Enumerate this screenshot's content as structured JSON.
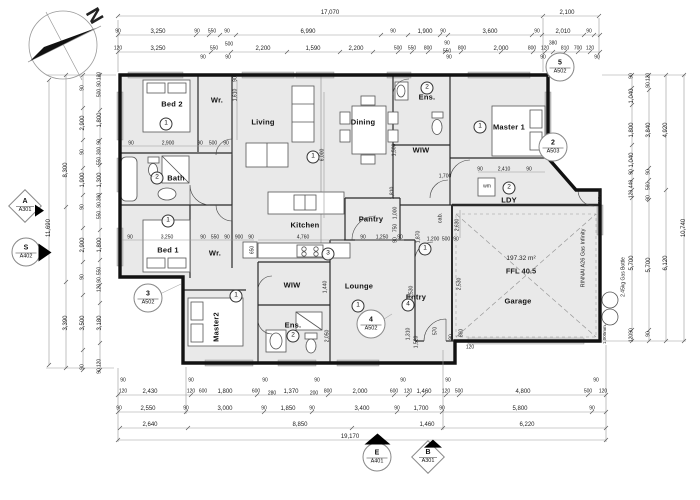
{
  "compass": {
    "north_label": "N"
  },
  "rooms": [
    [
      "Bed 2",
      172,
      104,
      0
    ],
    [
      "Wr.",
      217,
      100,
      0
    ],
    [
      "Living",
      263,
      122,
      0
    ],
    [
      "Dining",
      363,
      122,
      0
    ],
    [
      "Ens.",
      427,
      97,
      0
    ],
    [
      "Master 1",
      509,
      127,
      0
    ],
    [
      "WIW",
      421,
      150,
      0
    ],
    [
      "LDY",
      509,
      200,
      0
    ],
    [
      "Bath",
      176,
      178,
      0
    ],
    [
      "Bed 1",
      168,
      250,
      0
    ],
    [
      "Wr.",
      215,
      253,
      0
    ],
    [
      "Kitchen",
      305,
      225,
      0
    ],
    [
      "Pantry",
      371,
      219,
      0
    ],
    [
      "WIW",
      292,
      285,
      0
    ],
    [
      "Master2",
      216,
      327,
      -90
    ],
    [
      "Ens.",
      293,
      325,
      0
    ],
    [
      "Lounge",
      359,
      286,
      0
    ],
    [
      "Entry",
      416,
      297,
      0
    ],
    [
      "Garage",
      518,
      301,
      0
    ]
  ],
  "room_numbers": [
    {
      "n": "1",
      "x": 166,
      "y": 124
    },
    {
      "n": "2",
      "x": 157,
      "y": 178
    },
    {
      "n": "1",
      "x": 168,
      "y": 221
    },
    {
      "n": "1",
      "x": 313,
      "y": 157
    },
    {
      "n": "2",
      "x": 427,
      "y": 88
    },
    {
      "n": "1",
      "x": 480,
      "y": 127
    },
    {
      "n": "2",
      "x": 509,
      "y": 188
    },
    {
      "n": "3",
      "x": 328,
      "y": 254
    },
    {
      "n": "1",
      "x": 425,
      "y": 249
    },
    {
      "n": "1",
      "x": 236,
      "y": 296
    },
    {
      "n": "2",
      "x": 293,
      "y": 336
    },
    {
      "n": "1",
      "x": 358,
      "y": 306
    },
    {
      "n": "4",
      "x": 408,
      "y": 305
    }
  ],
  "markers": [
    {
      "n": "5",
      "code": "A502",
      "x": 560,
      "y": 67,
      "shape": "circle"
    },
    {
      "n": "2",
      "code": "A503",
      "x": 553,
      "y": 147,
      "shape": "circle"
    },
    {
      "n": "3",
      "code": "A502",
      "x": 148,
      "y": 298,
      "shape": "circle"
    },
    {
      "n": "4",
      "code": "A502",
      "x": 371,
      "y": 324,
      "shape": "circle"
    },
    {
      "n": "A",
      "code": "A301",
      "x": 25,
      "y": 206,
      "shape": "diamond ar-right"
    },
    {
      "n": "S",
      "code": "A402",
      "x": 26,
      "y": 252,
      "shape": "circle ar-right"
    },
    {
      "n": "E",
      "code": "A401",
      "x": 377,
      "y": 457,
      "shape": "circle ar-up"
    },
    {
      "n": "B",
      "code": "A301",
      "x": 428,
      "y": 457,
      "shape": "diamond ar-up"
    }
  ],
  "annotations": [
    {
      "t": "197.32 m²",
      "x": 521,
      "y": 259,
      "s": 6.5,
      "n": "area-label"
    },
    {
      "t": "FFL 40.5",
      "x": 521,
      "y": 271,
      "s": 7.5,
      "b": 1,
      "n": "ffl-label"
    },
    {
      "t": "RINNAI A26 Gas Infinity",
      "x": 584,
      "y": 258,
      "r": -90,
      "s": 5.5,
      "n": "gas-heater-label"
    },
    {
      "t": "2.45kg Gas Bottle",
      "x": 624,
      "y": 277,
      "r": -90,
      "s": 5,
      "n": "gas-bottle-label"
    },
    {
      "t": "1,000mm.",
      "x": 605,
      "y": 334,
      "r": -90,
      "s": 4.5,
      "n": "offset-label"
    },
    {
      "t": "300mm.",
      "x": 600,
      "y": 196,
      "r": -90,
      "s": 4.5,
      "n": "offset-label"
    },
    {
      "t": "wm",
      "x": 487,
      "y": 187,
      "s": 5,
      "n": "washing-machine-label"
    },
    {
      "t": "cab.",
      "x": 441,
      "y": 218,
      "r": -90,
      "s": 5.5,
      "n": "cabinet-label"
    },
    {
      "t": "N",
      "x": 94,
      "y": 16,
      "r": 60,
      "s": 20,
      "b": 1,
      "n": "north-label"
    }
  ],
  "dims": [
    [
      "17,070",
      330,
      13
    ],
    [
      "2,100",
      567,
      13
    ],
    [
      "90",
      118,
      32,
      0,
      5
    ],
    [
      "3,250",
      158,
      32
    ],
    [
      "90",
      197,
      32,
      0,
      5
    ],
    [
      "550",
      212,
      32,
      0,
      5
    ],
    [
      "90",
      227,
      32,
      0,
      5
    ],
    [
      "6,990",
      308,
      32
    ],
    [
      "90",
      393,
      32,
      0,
      5
    ],
    [
      "1,900",
      425,
      32
    ],
    [
      "90",
      443,
      32,
      0,
      5
    ],
    [
      "3,600",
      490,
      32
    ],
    [
      "90",
      537,
      32,
      0,
      5
    ],
    [
      "2,010",
      563,
      32
    ],
    [
      "90",
      589,
      32,
      0,
      5
    ],
    [
      "120",
      118,
      49,
      0,
      5
    ],
    [
      "3,250",
      158,
      49
    ],
    [
      "550",
      214,
      49,
      0,
      5
    ],
    [
      "500",
      229,
      45,
      0,
      5
    ],
    [
      "2,200",
      263,
      49
    ],
    [
      "1,590",
      313,
      49
    ],
    [
      "2,200",
      356,
      49
    ],
    [
      "500",
      398,
      49,
      0,
      5
    ],
    [
      "550",
      412,
      49,
      0,
      5
    ],
    [
      "800",
      428,
      49,
      0,
      5
    ],
    [
      "90",
      447,
      44,
      0,
      5
    ],
    [
      "550",
      447,
      52,
      0,
      5
    ],
    [
      "800",
      462,
      49,
      0,
      5
    ],
    [
      "2,000",
      501,
      49
    ],
    [
      "800",
      532,
      49,
      0,
      5
    ],
    [
      "120",
      545,
      49,
      0,
      5
    ],
    [
      "380",
      553,
      44,
      0,
      5
    ],
    [
      "810",
      565,
      49,
      0,
      5
    ],
    [
      "700",
      578,
      49,
      0,
      5
    ],
    [
      "120",
      590,
      49,
      0,
      5
    ],
    [
      "90",
      203,
      58,
      0,
      5
    ],
    [
      "90",
      228,
      58,
      0,
      5
    ],
    [
      "90",
      449,
      58,
      0,
      5
    ],
    [
      "90",
      543,
      58,
      0,
      5
    ],
    [
      "90",
      597,
      58,
      0,
      5
    ],
    [
      "90",
      123,
      381,
      0,
      5
    ],
    [
      "90",
      191,
      381,
      0,
      5
    ],
    [
      "90",
      265,
      381,
      0,
      5
    ],
    [
      "90",
      317,
      381,
      0,
      5
    ],
    [
      "90",
      403,
      381,
      0,
      5
    ],
    [
      "90",
      448,
      381,
      0,
      5
    ],
    [
      "90",
      596,
      381,
      0,
      5
    ],
    [
      "120",
      123,
      392,
      0,
      5
    ],
    [
      "2,430",
      150,
      392
    ],
    [
      "120",
      191,
      392,
      0,
      5
    ],
    [
      "600",
      203,
      392,
      0,
      5
    ],
    [
      "1,800",
      225,
      392
    ],
    [
      "600",
      256,
      392,
      0,
      5
    ],
    [
      "280",
      272,
      394,
      0,
      5
    ],
    [
      "1,370",
      291,
      392
    ],
    [
      "200",
      314,
      394,
      0,
      5
    ],
    [
      "800",
      328,
      392,
      0,
      5
    ],
    [
      "2,000",
      360,
      392
    ],
    [
      "600",
      394,
      392,
      0,
      5
    ],
    [
      "120",
      408,
      392,
      0,
      5
    ],
    [
      "1,460",
      424,
      392
    ],
    [
      "120",
      446,
      392,
      0,
      5
    ],
    [
      "500",
      459,
      392,
      0,
      5
    ],
    [
      "4,800",
      523,
      392
    ],
    [
      "500",
      588,
      392,
      0,
      5
    ],
    [
      "120",
      603,
      392,
      0,
      5
    ],
    [
      "90",
      119,
      409,
      0,
      5
    ],
    [
      "2,550",
      148,
      409
    ],
    [
      "90",
      186,
      409,
      0,
      5
    ],
    [
      "3,000",
      225,
      409
    ],
    [
      "90",
      264,
      409,
      0,
      5
    ],
    [
      "1,850",
      288,
      409
    ],
    [
      "90",
      312,
      409,
      0,
      5
    ],
    [
      "3,400",
      362,
      409
    ],
    [
      "90",
      397,
      409,
      0,
      5
    ],
    [
      "1,700",
      421,
      409
    ],
    [
      "90",
      442,
      409,
      0,
      5
    ],
    [
      "5,800",
      520,
      409
    ],
    [
      "90",
      592,
      409,
      0,
      5
    ],
    [
      "2,640",
      150,
      425
    ],
    [
      "8,850",
      300,
      425
    ],
    [
      "1,460",
      427,
      425
    ],
    [
      "6,220",
      527,
      425
    ],
    [
      "19,170",
      350,
      437
    ],
    [
      "120",
      100,
      76,
      -90,
      5
    ],
    [
      "90",
      100,
      84,
      -90,
      5
    ],
    [
      "500",
      100,
      93,
      -90,
      5
    ],
    [
      "1,800",
      100,
      120,
      -90
    ],
    [
      "90",
      100,
      142,
      -90,
      5
    ],
    [
      "300",
      100,
      151,
      -90,
      5
    ],
    [
      "550",
      100,
      161,
      -90,
      5
    ],
    [
      "1,300",
      100,
      180,
      -90
    ],
    [
      "300",
      100,
      197,
      -90,
      5
    ],
    [
      "90",
      100,
      205,
      -90,
      5
    ],
    [
      "550",
      100,
      215,
      -90,
      5
    ],
    [
      "1,800",
      100,
      245,
      -90
    ],
    [
      "550",
      100,
      271,
      -90,
      5
    ],
    [
      "90",
      100,
      280,
      -90,
      5
    ],
    [
      "120",
      100,
      288,
      -90,
      5
    ],
    [
      "3,180",
      100,
      323,
      -90
    ],
    [
      "120",
      100,
      363,
      -90,
      5
    ],
    [
      "90",
      100,
      371,
      -90,
      5
    ],
    [
      "90",
      83,
      88,
      -90,
      5
    ],
    [
      "2,900",
      83,
      123,
      -90
    ],
    [
      "90",
      83,
      152,
      -90,
      5
    ],
    [
      "1,900",
      83,
      180,
      -90
    ],
    [
      "90",
      83,
      207,
      -90,
      5
    ],
    [
      "2,900",
      83,
      245,
      -90
    ],
    [
      "90",
      83,
      277,
      -90,
      5
    ],
    [
      "3,500",
      83,
      323,
      -90
    ],
    [
      "90",
      83,
      367,
      -90,
      5
    ],
    [
      "8,300",
      66,
      170,
      -90
    ],
    [
      "3,390",
      66,
      323,
      -90
    ],
    [
      "11,690",
      49,
      228,
      -90
    ],
    [
      "90",
      632,
      76,
      -90,
      5
    ],
    [
      "1,040",
      632,
      96,
      -90
    ],
    [
      "1,800",
      632,
      130,
      -90
    ],
    [
      "1,040",
      632,
      160,
      -90
    ],
    [
      "90",
      632,
      172,
      -90,
      5
    ],
    [
      "440",
      632,
      184,
      -90,
      5
    ],
    [
      "120",
      632,
      194,
      -90,
      5
    ],
    [
      "5,700",
      632,
      263,
      -90
    ],
    [
      "90",
      632,
      331,
      -90,
      5
    ],
    [
      "120",
      632,
      338,
      -90,
      5
    ],
    [
      "120",
      649,
      77,
      -90,
      5
    ],
    [
      "90",
      649,
      85,
      -90,
      5
    ],
    [
      "3,840",
      649,
      130,
      -90
    ],
    [
      "90",
      649,
      172,
      -90,
      5
    ],
    [
      "560",
      649,
      186,
      -90,
      5
    ],
    [
      "90",
      649,
      198,
      -90,
      5
    ],
    [
      "5,700",
      649,
      265,
      -90
    ],
    [
      "90",
      649,
      334,
      -90,
      5
    ],
    [
      "4,920",
      666,
      130,
      -90
    ],
    [
      "6,120",
      666,
      263,
      -90
    ],
    [
      "10,740",
      684,
      228,
      -90
    ],
    [
      "90",
      131,
      144,
      0,
      5
    ],
    [
      "2,900",
      168,
      144,
      0,
      5
    ],
    [
      "90",
      200,
      144,
      0,
      5
    ],
    [
      "500",
      213,
      144,
      0,
      5
    ],
    [
      "90",
      226,
      144,
      0,
      5
    ],
    [
      "90",
      130,
      238,
      0,
      5
    ],
    [
      "3,250",
      167,
      238,
      0,
      5
    ],
    [
      "90",
      203,
      238,
      0,
      5
    ],
    [
      "550",
      215,
      238,
      0,
      5
    ],
    [
      "90",
      227,
      238,
      0,
      5
    ],
    [
      "900",
      239,
      238,
      0,
      5
    ],
    [
      "90",
      251,
      238,
      0,
      5
    ],
    [
      "1,610",
      236,
      95,
      -90,
      5
    ],
    [
      "90",
      236,
      79,
      -90,
      5
    ],
    [
      "6,000",
      323,
      155,
      -90,
      5
    ],
    [
      "1,000",
      396,
      213,
      -90,
      5
    ],
    [
      "750",
      396,
      228,
      -90,
      5
    ],
    [
      "90",
      396,
      240,
      -90,
      5
    ],
    [
      "4,760",
      303,
      238,
      0,
      5
    ],
    [
      "90",
      363,
      238,
      0,
      5
    ],
    [
      "1,250",
      382,
      238,
      0,
      5
    ],
    [
      "90",
      400,
      238,
      0,
      5
    ],
    [
      "1,870",
      419,
      237,
      -90,
      5
    ],
    [
      "1,200",
      433,
      240,
      0,
      5
    ],
    [
      "500",
      446,
      240,
      0,
      5
    ],
    [
      "90",
      456,
      240,
      0,
      5
    ],
    [
      "1,500",
      395,
      150,
      -90,
      5
    ],
    [
      "1,810",
      393,
      193,
      -90,
      5
    ],
    [
      "1,700",
      445,
      177,
      0,
      5
    ],
    [
      "90",
      480,
      170,
      0,
      5
    ],
    [
      "2,410",
      504,
      170,
      0,
      5
    ],
    [
      "90",
      529,
      170,
      0,
      5
    ],
    [
      "2,630",
      458,
      225,
      -90,
      5
    ],
    [
      "2,530",
      412,
      292,
      -90,
      5
    ],
    [
      "2,530",
      460,
      284,
      -90,
      5
    ],
    [
      "1,440",
      326,
      287,
      -90,
      5
    ],
    [
      "2,050",
      328,
      336,
      -90,
      5
    ],
    [
      "1,310",
      409,
      334,
      -90,
      5
    ],
    [
      "1,520",
      417,
      342,
      -90,
      5
    ],
    [
      "570",
      436,
      331,
      -90,
      5
    ],
    [
      "860",
      462,
      333,
      -90,
      5
    ],
    [
      "90",
      452,
      337,
      -90,
      5
    ],
    [
      "120",
      470,
      348,
      0,
      5
    ],
    [
      "650",
      253,
      250,
      -90,
      5
    ]
  ]
}
